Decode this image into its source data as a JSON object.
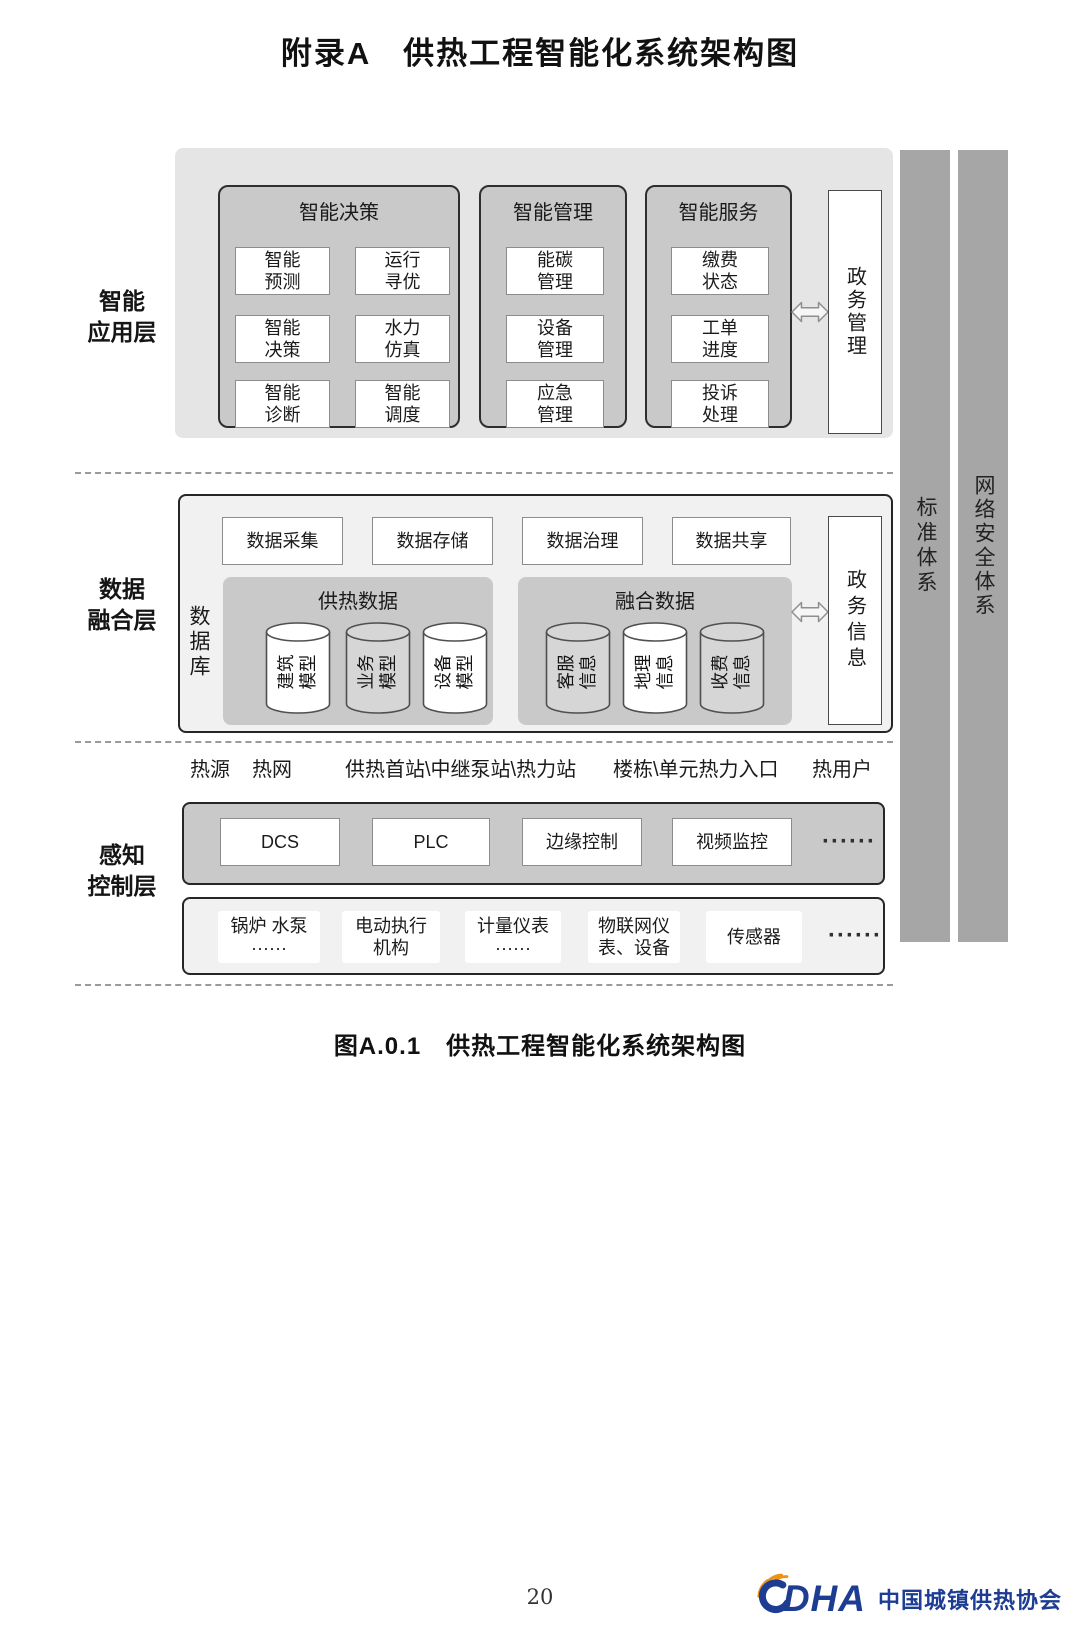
{
  "title": "附录A　供热工程智能化系统架构图",
  "caption": "图A.0.1　供热工程智能化系统架构图",
  "page_number": "20",
  "application_layer": {
    "label": "智能\n应用层",
    "decision_group": {
      "title": "智能决策",
      "items": [
        "智能\n预测",
        "运行\n寻优",
        "智能\n决策",
        "水力\n仿真",
        "智能\n诊断",
        "智能\n调度"
      ]
    },
    "management_group": {
      "title": "智能管理",
      "items": [
        "能碳\n管理",
        "设备\n管理",
        "应急\n管理"
      ]
    },
    "service_group": {
      "title": "智能服务",
      "items": [
        "缴费\n状态",
        "工单\n进度",
        "投诉\n处理"
      ]
    },
    "gov_box": "政务管理"
  },
  "data_layer": {
    "label": "数据\n融合层",
    "process_boxes": [
      "数据采集",
      "数据存储",
      "数据治理",
      "数据共享"
    ],
    "database_label": "数据库",
    "heating_group": {
      "title": "供热数据",
      "cylinders": [
        {
          "label": "建筑\n模型",
          "fill": "#ffffff"
        },
        {
          "label": "业务\n模型",
          "fill": "#d6d6d6"
        },
        {
          "label": "设备\n模型",
          "fill": "#ffffff"
        }
      ]
    },
    "fusion_group": {
      "title": "融合数据",
      "cylinders": [
        {
          "label": "客服\n信息",
          "fill": "#d6d6d6"
        },
        {
          "label": "地理\n信息",
          "fill": "#ffffff"
        },
        {
          "label": "收费\n信息",
          "fill": "#d6d6d6"
        }
      ]
    },
    "gov_box": "政务信息"
  },
  "perception_layer": {
    "label": "感知\n控制层",
    "facilities": [
      "热源",
      "热网",
      "供热首站\\中继泵站\\热力站",
      "楼栋\\单元热力入口",
      "热用户"
    ],
    "control_boxes": [
      "DCS",
      "PLC",
      "边缘控制",
      "视频监控"
    ],
    "control_ellipsis": "······",
    "device_boxes": [
      "锅炉 水泵\n······",
      "电动执行\n机构",
      "计量仪表\n······",
      "物联网仪\n表、设备",
      "传感器"
    ],
    "device_ellipsis": "······"
  },
  "side_bars": {
    "standard": "标准体系",
    "security": "网络安全体系"
  },
  "logo": {
    "acronym": "DHA",
    "name": "中国城镇供热协会",
    "blue": "#1d3d93",
    "orange": "#ef9213"
  }
}
